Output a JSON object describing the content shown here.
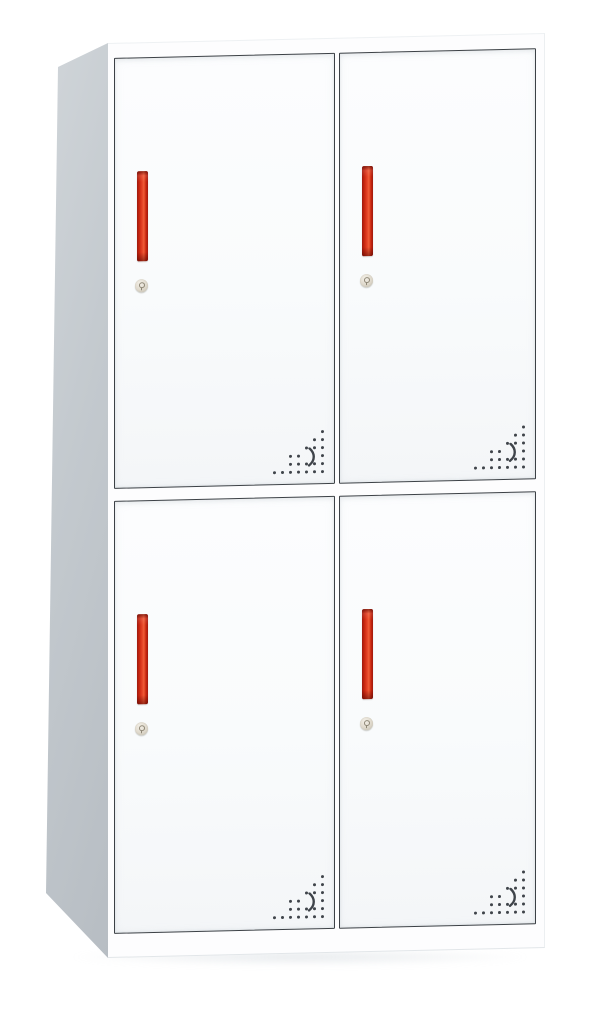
{
  "image_type": "product-photo",
  "subject": "four-door-metal-locker-cabinet",
  "background_color": "#ffffff",
  "cabinet": {
    "layout": {
      "door_rows": 2,
      "door_columns": 2,
      "door_count": 4,
      "side_panel_visible": "left"
    },
    "doors": [
      {
        "id": "top-left",
        "row": "top",
        "column": "left",
        "handle": true,
        "lock": true,
        "vent": true
      },
      {
        "id": "top-right",
        "row": "top",
        "column": "right",
        "handle": true,
        "lock": true,
        "vent": true
      },
      {
        "id": "bottom-left",
        "row": "bottom",
        "column": "left",
        "handle": true,
        "lock": true,
        "vent": true
      },
      {
        "id": "bottom-right",
        "row": "bottom",
        "column": "right",
        "handle": true,
        "lock": true,
        "vent": true
      }
    ],
    "vent": {
      "dot_spacing_px": 8,
      "dot_size_px": 3,
      "pattern_rows": [
        "......#",
        ".....##",
        "....###",
        "..##..#",
        "..#####",
        "#######"
      ],
      "swoosh": true
    },
    "colors": {
      "frame": "#fdfdfe",
      "side_light": "#d0d5d9",
      "side_mid": "#c3c9ce",
      "side_dark": "#b7bdc3",
      "door_top": "#fcfdfe",
      "door_bottom": "#f4f6f8",
      "outline": "#3c4146",
      "dot": "#3f444a",
      "handle_edge_dark": "#9e1a0e",
      "handle_red": "#c9260f",
      "handle_core": "#e64528",
      "handle_bright": "#ef5c36",
      "lock_light": "#f4f0e8",
      "lock_mid": "#ded8cb",
      "lock_dark": "#c2bcae",
      "lock_detail": "#8e8776",
      "floor_shadow": "rgba(196,204,211,0.40)"
    }
  }
}
